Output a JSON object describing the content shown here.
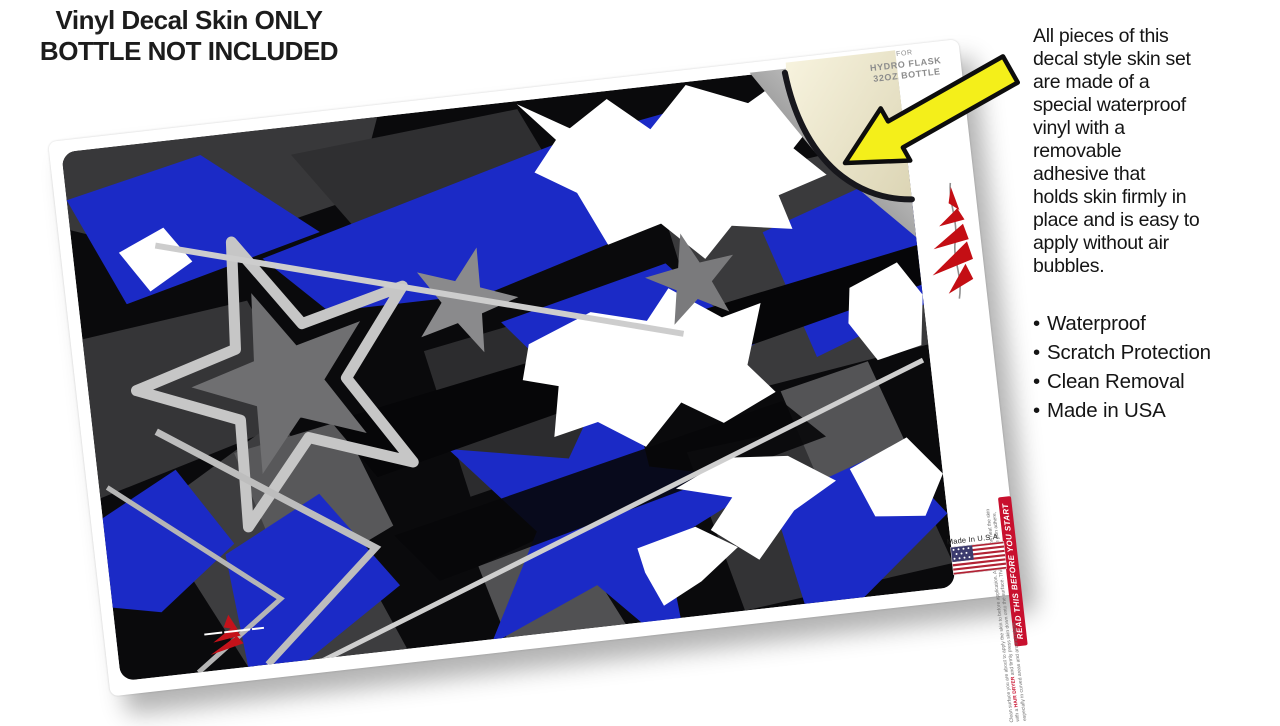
{
  "headline": {
    "line1": "Vinyl Decal Skin ONLY",
    "line2": "BOTTLE NOT INCLUDED"
  },
  "description": {
    "text": "All pieces of this\ndecal style  skin set\nare made of a\nspecial waterproof\nvinyl with a\nremovable\nadhesive that\nholds skin firmly in\nplace and is easy to\napply without air\nbubbles."
  },
  "features": [
    "Waterproof",
    "Scratch Protection",
    "Clean Removal",
    "Made in USA"
  ],
  "product_sheet": {
    "fit_label": {
      "line1": "for",
      "line2": "Hydro Flask",
      "line3": "32oz Bottle"
    },
    "banner": "READ THIS BEFORE YOU START",
    "instructions_pre": "Clean surface you are about to apply the skin to before application. After application heat the skin with a ",
    "instructions_em": "HAIR DRYER",
    "instructions_post": " and firmly press skin down onto the surface. This will help the skin adhere, especially in curved areas and around edges.",
    "made_in": "Made In U.S.A."
  },
  "icons": {
    "arrow": "yellow-pointer-arrow",
    "flag": "us-flag",
    "brand_logo": "red-claw-logo",
    "mini_logo": "red-claw-mini-logo"
  },
  "colors": {
    "accent_blue": "#1b2ac6",
    "arrow_yellow": "#f4ef1a",
    "backing_cream": "#eee9d2",
    "banner_red": "#c8102e",
    "flag_red": "#b22234",
    "flag_blue": "#3c3b6e",
    "logo_red": "#c40e14",
    "art_black": "#0a0a0c",
    "art_silver": "#c9c9c9"
  }
}
